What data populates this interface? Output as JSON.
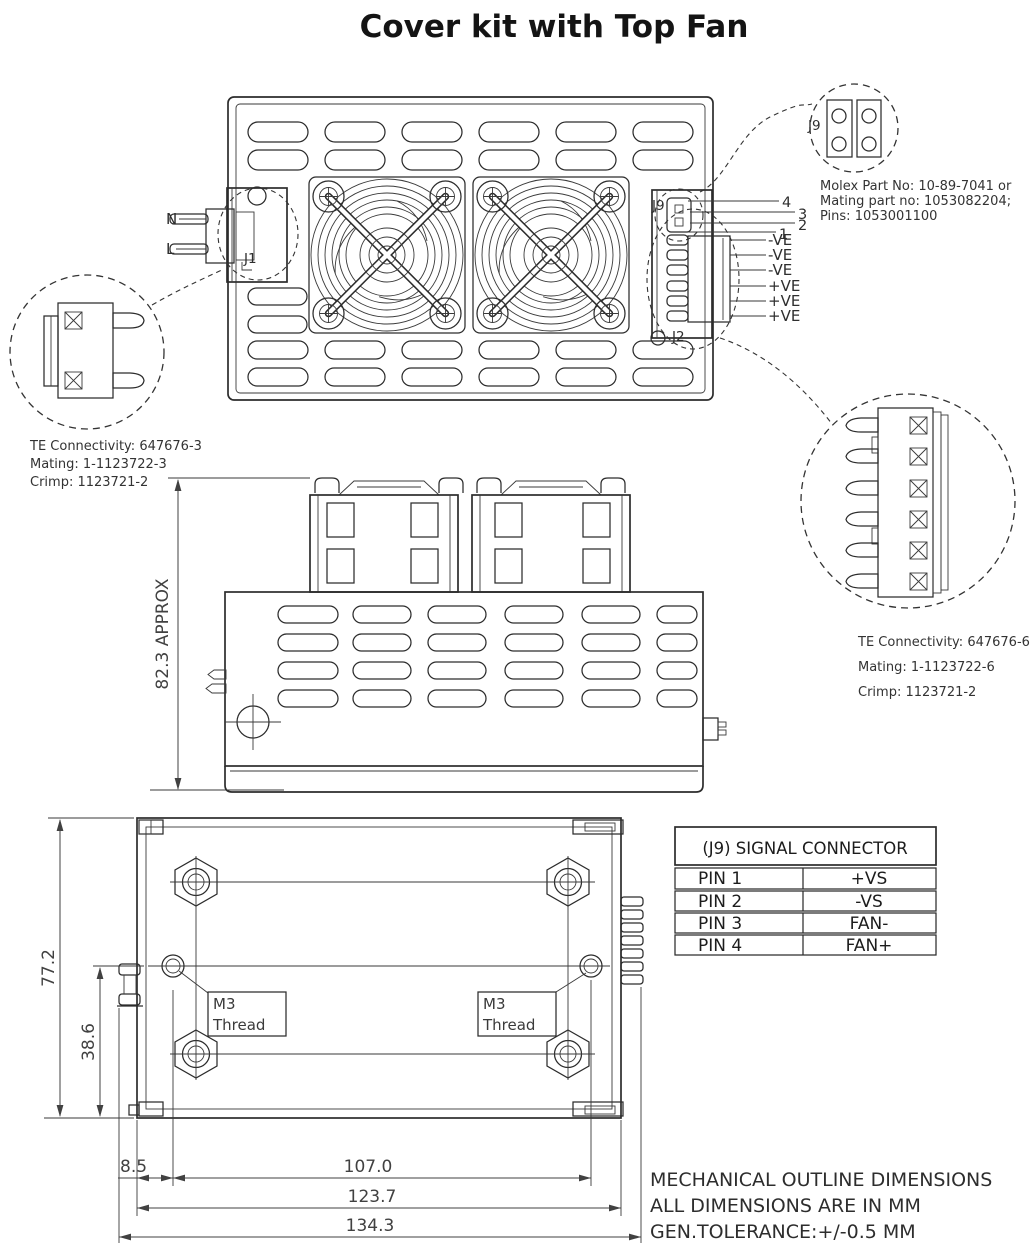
{
  "title": "Cover kit with Top Fan",
  "top_view": {
    "n_label": "N",
    "l_label": "L",
    "j1_label": "J1",
    "j9_label": "J9",
    "j2_label": "J2",
    "j9_pins": [
      "4",
      "3",
      "2",
      "1"
    ],
    "j2_pins": [
      "-VE",
      "-VE",
      "-VE",
      "+VE",
      "+VE",
      "+VE"
    ]
  },
  "detail_top_right": {
    "j9_label": "J9",
    "lines": [
      "Molex Part No: 10-89-7041 or",
      "Mating part no: 1053082204;",
      "Pins: 1053001100"
    ]
  },
  "detail_left": {
    "lines": [
      "TE Connectivity: 647676-3",
      "Mating: 1-1123722-3",
      "Crimp: 1123721-2"
    ]
  },
  "detail_right": {
    "lines": [
      "TE Connectivity: 647676-6",
      "Mating: 1-1123722-6",
      "Crimp: 1123721-2"
    ]
  },
  "side_view": {
    "height_dim": "82.3 APPROX"
  },
  "bottom_view": {
    "dims": {
      "overall_height": "77.2",
      "center_height": "38.6",
      "offset": "8.5",
      "hole_span": "107.0",
      "body_width": "123.7",
      "overall_width": "134.3"
    },
    "m3_label_line1": "M3",
    "m3_label_line2": "Thread"
  },
  "signal_table": {
    "title": "(J9) SIGNAL CONNECTOR",
    "rows": [
      {
        "pin": "PIN 1",
        "signal": "+VS"
      },
      {
        "pin": "PIN 2",
        "signal": "-VS"
      },
      {
        "pin": "PIN 3",
        "signal": "FAN-"
      },
      {
        "pin": "PIN 4",
        "signal": "FAN+"
      }
    ]
  },
  "notes": [
    "MECHANICAL OUTLINE DIMENSIONS",
    "ALL DIMENSIONS ARE IN MM",
    "GEN.TOLERANCE:+/-0.5 MM"
  ],
  "colors": {
    "line": "#2c2c2c",
    "text": "#333333",
    "background": "#ffffff"
  }
}
